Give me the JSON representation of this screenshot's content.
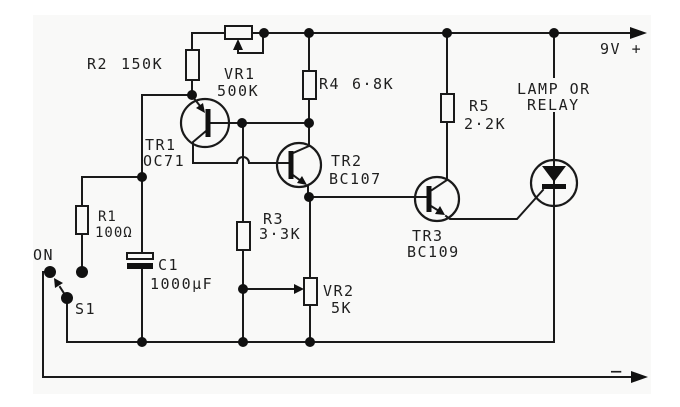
{
  "figure": {
    "type": "schematic-circuit-diagram",
    "description": "Transistor delay switch circuit driving lamp or relay",
    "ink_color": "#1a1a1a",
    "paper_color": "#f9f9f8"
  },
  "power": {
    "positive_label": "9V +",
    "negative_label": "−"
  },
  "switch": {
    "ref": "S1",
    "position_label": "ON"
  },
  "load": {
    "line1": "LAMP OR",
    "line2": "RELAY"
  },
  "components": {
    "r1": {
      "ref": "R1",
      "value": "100Ω",
      "type": "resistor"
    },
    "r2": {
      "ref": "R2",
      "value": "150K",
      "type": "resistor"
    },
    "r3": {
      "ref": "R3",
      "value": "3·3K",
      "type": "resistor"
    },
    "r4": {
      "ref": "R4",
      "value": "6·8K",
      "type": "resistor"
    },
    "r5": {
      "ref": "R5",
      "value": "2·2K",
      "type": "resistor"
    },
    "vr1": {
      "ref": "VR1",
      "value": "500K",
      "type": "potentiometer"
    },
    "vr2": {
      "ref": "VR2",
      "value": "5K",
      "type": "potentiometer"
    },
    "c1": {
      "ref": "C1",
      "value": "1000µF",
      "type": "electrolytic-capacitor"
    },
    "tr1": {
      "ref": "TR1",
      "value": "OC71",
      "type": "pnp-transistor"
    },
    "tr2": {
      "ref": "TR2",
      "value": "BC107",
      "type": "npn-transistor"
    },
    "tr3": {
      "ref": "TR3",
      "value": "BC109",
      "type": "npn-transistor"
    }
  }
}
